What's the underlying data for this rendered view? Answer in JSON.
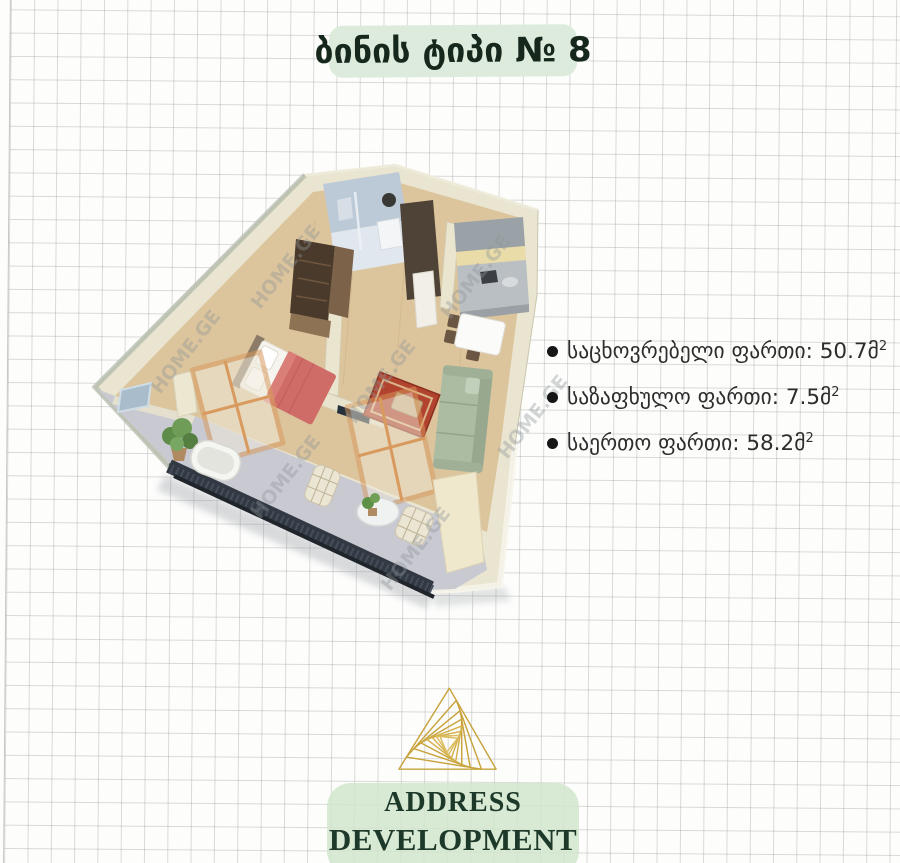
{
  "page": {
    "title": "ბინის ტიპი № 8"
  },
  "areas": {
    "items": [
      {
        "text": "საცხოვრებელი ფართი: 50.7მ",
        "sup": "2"
      },
      {
        "text": "საზაფხულო ფართი: 7.5მ",
        "sup": "2"
      },
      {
        "text": "საერთო ფართი: 58.2მ",
        "sup": "2"
      }
    ]
  },
  "watermark": {
    "text": "HOME.GE"
  },
  "brand": {
    "line1": "ADDRESS",
    "line2": "DEVELOPMENT"
  },
  "colors": {
    "title_highlight": "#dcebdc",
    "title_text": "#16281c",
    "body_text": "#2d2d2d",
    "brand_text": "#1d392a",
    "logo_gold": "#c8a33b"
  }
}
